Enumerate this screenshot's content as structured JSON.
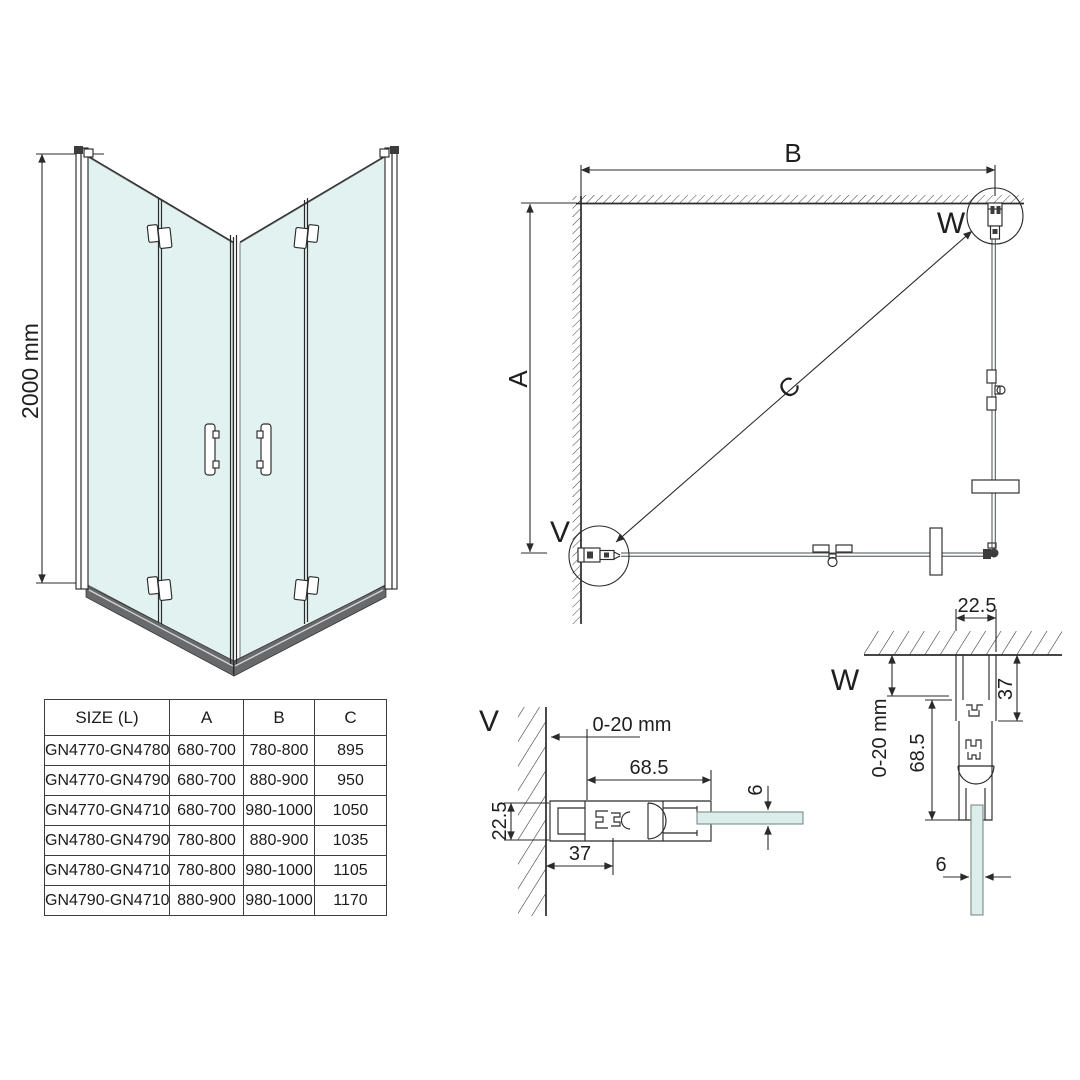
{
  "colors": {
    "line": "#2b2b2b",
    "glass_3d": "#e2f2f0",
    "glass_detail": "#dceeec",
    "base_strip": "#68696b",
    "table_border": "#3d3d3d"
  },
  "front_view": {
    "height_dim": "2000 mm"
  },
  "plan_view": {
    "dim_width": "B",
    "dim_depth": "A",
    "dim_diagonal": "C",
    "detail_left_label": "V",
    "detail_right_label": "W"
  },
  "detail_v": {
    "label": "V",
    "adjust_range": "0-20 mm",
    "profile_length": "68.5",
    "profile_depth": "22.5",
    "fixed_part": "37",
    "glass_thickness": "6"
  },
  "detail_w": {
    "label": "W",
    "profile_depth": "22.5",
    "fixed_part": "37",
    "adjust_range": "0-20 mm",
    "profile_length": "68.5",
    "glass_thickness": "6"
  },
  "size_table": {
    "headers": [
      "SIZE (L)",
      "A",
      "B",
      "C"
    ],
    "rows": [
      [
        "GN4770-GN4780",
        "680-700",
        "780-800",
        "895"
      ],
      [
        "GN4770-GN4790",
        "680-700",
        "880-900",
        "950"
      ],
      [
        "GN4770-GN4710",
        "680-700",
        "980-1000",
        "1050"
      ],
      [
        "GN4780-GN4790",
        "780-800",
        "880-900",
        "1035"
      ],
      [
        "GN4780-GN4710",
        "780-800",
        "980-1000",
        "1105"
      ],
      [
        "GN4790-GN4710",
        "880-900",
        "980-1000",
        "1170"
      ]
    ]
  }
}
